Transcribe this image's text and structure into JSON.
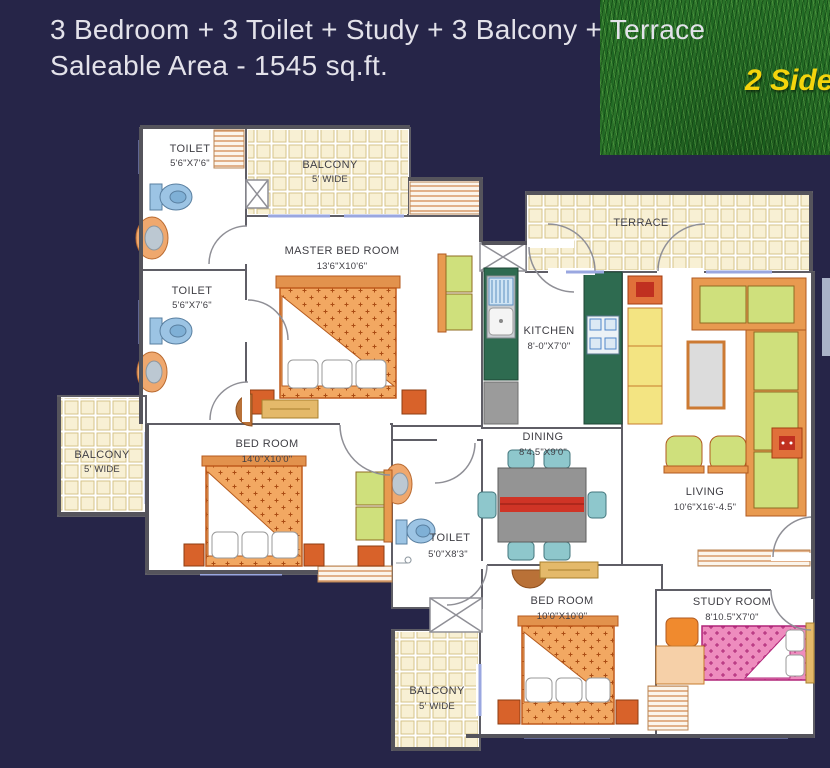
{
  "header": {
    "line1": "3 Bedroom + 3 Toilet + Study + 3 Balcony + Terrace",
    "line2": "Saleable Area  - 1545 sq.ft."
  },
  "corner_badge": {
    "text": "2 Side"
  },
  "colors": {
    "background": "#262548",
    "badge_yellow": "#f4d40c",
    "grass_green": "#2a7229",
    "tile_cream": "#f8f0d4",
    "bed_orange": "#f2a862",
    "study_bed_pink": "#ee8cbe",
    "sofa_green": "#cfe07c",
    "sofa_frame_orange": "#e89a50",
    "kitchen_green": "#2e6b50",
    "fixture_blue": "#9cc4e4",
    "table_red": "#cf3426"
  },
  "plan": {
    "rooms": [
      {
        "name": "TOILET",
        "dims": "5'6\"X7'6\""
      },
      {
        "name": "BALCONY",
        "dims": "5' WIDE"
      },
      {
        "name": "MASTER BED ROOM",
        "dims": "13'6\"X10'6\""
      },
      {
        "name": "TOILET",
        "dims": "5'6\"X7'6\""
      },
      {
        "name": "BALCONY",
        "dims": "5' WIDE"
      },
      {
        "name": "BED ROOM",
        "dims": "14'0\"X10'0\""
      },
      {
        "name": "KITCHEN",
        "dims": "8'-0\"X7'0\""
      },
      {
        "name": "TERRACE",
        "dims": ""
      },
      {
        "name": "DINING",
        "dims": "8'4.5\"X9'0\""
      },
      {
        "name": "LIVING",
        "dims": "10'6\"X16'-4.5\""
      },
      {
        "name": "TOILET",
        "dims": "5'0\"X8'3\""
      },
      {
        "name": "BED ROOM",
        "dims": "10'0\"X10'0\""
      },
      {
        "name": "STUDY ROOM",
        "dims": "8'10.5\"X7'0\""
      },
      {
        "name": "BALCONY",
        "dims": "5' WIDE"
      }
    ]
  }
}
